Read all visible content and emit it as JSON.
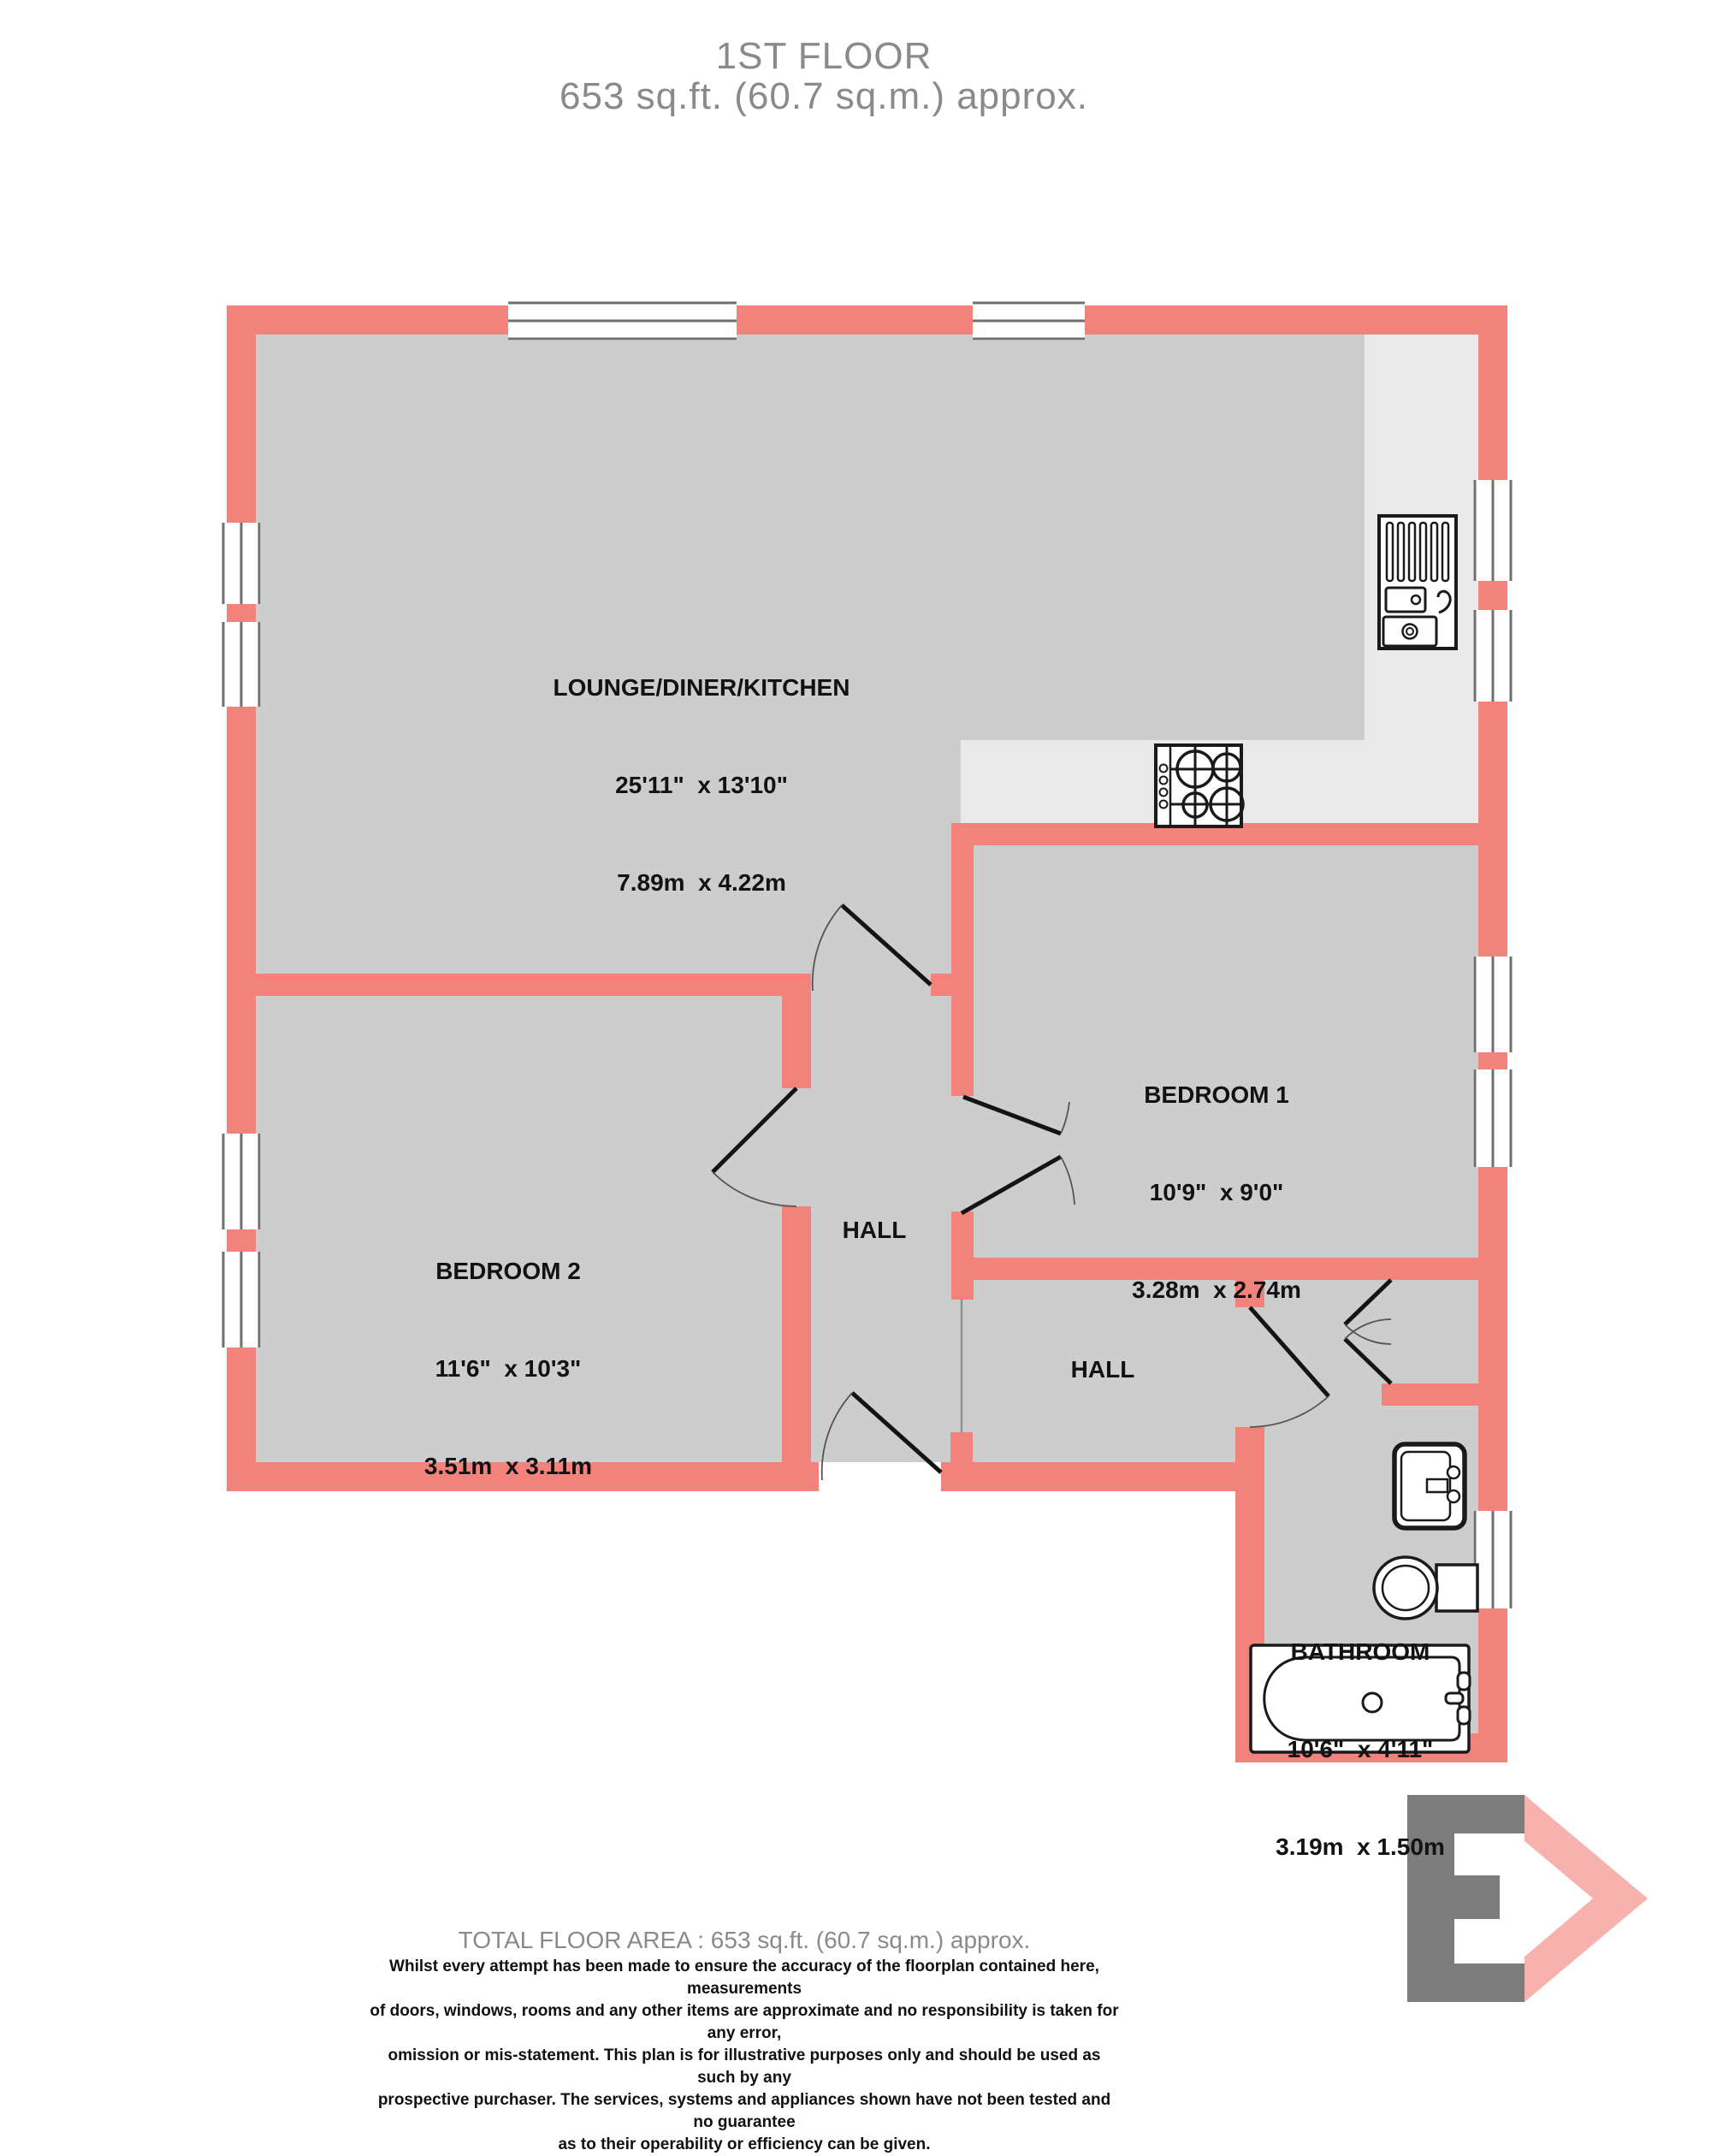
{
  "title": {
    "line1": "1ST FLOOR",
    "line2": "653 sq.ft. (60.7 sq.m.) approx."
  },
  "rooms": {
    "lounge": {
      "name": "LOUNGE/DINER/KITCHEN",
      "imperial": "25'11\"  x 13'10\"",
      "metric": "7.89m  x 4.22m"
    },
    "bedroom1": {
      "name": "BEDROOM 1",
      "imperial": "10'9\"  x 9'0\"",
      "metric": "3.28m  x 2.74m"
    },
    "bedroom2": {
      "name": "BEDROOM 2",
      "imperial": "11'6\"  x 10'3\"",
      "metric": "3.51m  x 3.11m"
    },
    "bathroom": {
      "name": "BATHROOM",
      "imperial": "10'6\"  x 4'11\"",
      "metric": "3.19m  x 1.50m"
    },
    "hall1": {
      "name": "HALL"
    },
    "hall2": {
      "name": "HALL"
    }
  },
  "footer": {
    "total_area": "TOTAL FLOOR AREA : 653 sq.ft. (60.7 sq.m.) approx.",
    "disclaimer": "Whilst every attempt has been made to ensure the accuracy of the floorplan contained here, measurements\nof doors, windows, rooms and any other items are approximate and no responsibility is taken for any error,\nomission or mis-statement. This plan is for illustrative purposes only and should be used as such by any\nprospective purchaser. The services, systems and appliances shown have not been tested and no guarantee\nas to their operability or efficiency can be given."
  },
  "fixtures": {
    "kitchen_sink": "kitchen sink with drainer",
    "hob": "4-ring hob",
    "bathroom_sink": "wash basin",
    "toilet": "toilet",
    "bathtub": "bathtub"
  },
  "colors": {
    "wall": "#F2837C",
    "floor": "#CDCDCD",
    "kitchen_floor": "#E9E9E9",
    "window_line": "#6F6F6F",
    "door_leaf": "#141414",
    "fixture_outline": "#1A1A1A",
    "title_text": "#8A8A8A",
    "label_text": "#121212",
    "logo_gray": "#7D7D7D",
    "logo_pink": "#F8B2AE"
  }
}
